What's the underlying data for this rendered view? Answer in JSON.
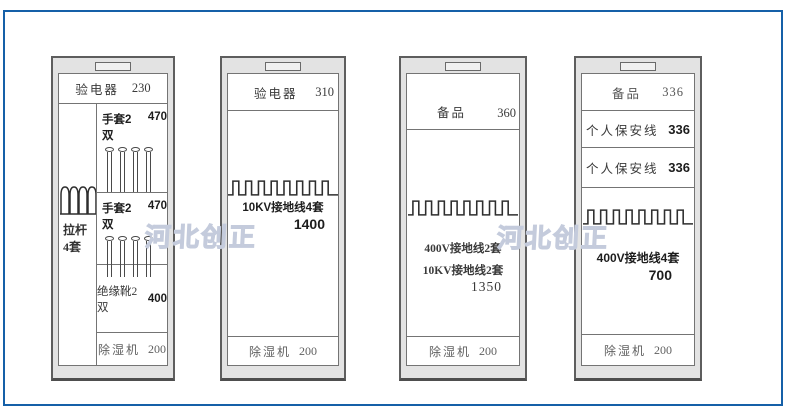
{
  "frame": {
    "border_color": "#1560a8"
  },
  "watermark": {
    "text": "河北创正",
    "color": "#c4cbdc"
  },
  "cabinet1": {
    "header": {
      "label": "验电器",
      "value": "230"
    },
    "pole": {
      "line1": "拉杆",
      "line2": "4套"
    },
    "glove_row_1": {
      "label": "手套2双",
      "value": "470"
    },
    "glove_row_2": {
      "label": "手套2双",
      "value": "470"
    },
    "boots_row": {
      "label": "绝缘靴2双",
      "value": "400"
    },
    "dehumidifier_row": {
      "label": "除湿机",
      "value": "200"
    }
  },
  "cabinet2": {
    "header": {
      "label": "验电器",
      "value": "310"
    },
    "main": {
      "label": "10KV接地线4套",
      "value": "1400"
    },
    "dehumidifier_row": {
      "label": "除湿机",
      "value": "200"
    }
  },
  "cabinet3": {
    "header": {
      "label": "备品",
      "value": "360"
    },
    "main": {
      "label1": "400V接地线2套",
      "label2": "10KV接地线2套",
      "value": "1350"
    },
    "dehumidifier_row": {
      "label": "除湿机",
      "value": "200"
    }
  },
  "cabinet4": {
    "header": {
      "label": "备品",
      "value": "336"
    },
    "safety_row_1": {
      "label": "个人保安线",
      "value": "336"
    },
    "safety_row_2": {
      "label": "个人保安线",
      "value": "336"
    },
    "main": {
      "label": "400V接地线4套",
      "value": "700"
    },
    "dehumidifier_row": {
      "label": "除湿机",
      "value": "200"
    }
  }
}
